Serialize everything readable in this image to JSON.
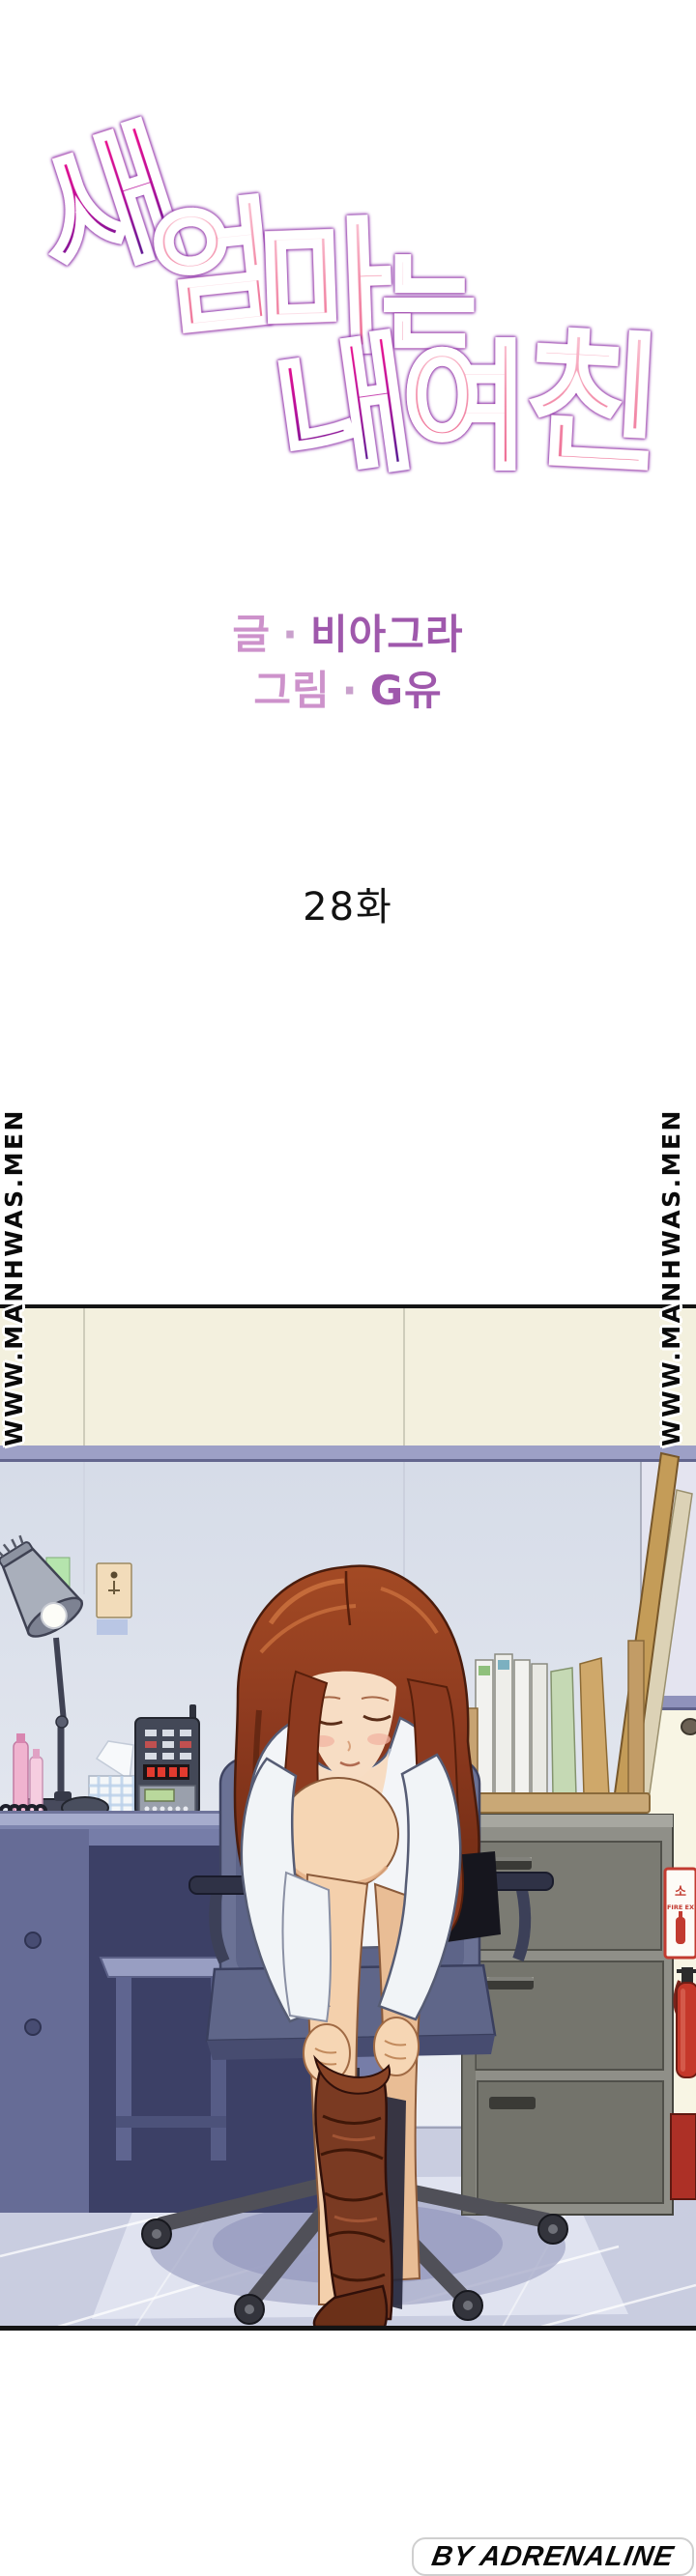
{
  "title": {
    "text": "새엄마는 내여친",
    "chars": [
      {
        "ch": "새",
        "palette": "purple"
      },
      {
        "ch": "엄",
        "palette": "pink"
      },
      {
        "ch": "마",
        "palette": "pink"
      },
      {
        "ch": "는",
        "palette": "pink"
      },
      {
        "ch": "내",
        "palette": "purple"
      },
      {
        "ch": "여",
        "palette": "pink"
      },
      {
        "ch": "친",
        "palette": "pink"
      }
    ]
  },
  "credits": {
    "writer_label": "글",
    "separator": "·",
    "writer_name": "비아그라",
    "artist_label": "그림",
    "artist_name": "G유"
  },
  "episode": {
    "label": "28화"
  },
  "watermark": {
    "text": "WWW.MANHWAS.MEN"
  },
  "panel": {
    "fire_sign": {
      "kr": "소",
      "en": "FIRE EX"
    }
  },
  "footer": {
    "credit": "BY ADRENALINE"
  },
  "colors": {
    "title_purple_top": "#ee108d",
    "title_purple_bottom": "#45178f",
    "title_pink_top": "#f9bccd",
    "title_pink_bottom": "#ee6d94",
    "title_outline": "#8b2fa8",
    "credit_label": "#cd92cb",
    "credit_name": "#9f58ac",
    "episode_text": "#121212",
    "watermark_fill": "#0a0a0a",
    "wall_cream": "#f3f0de",
    "wall_blue": "#dbe1ec",
    "wall_trim": "#9da0c6",
    "floor": "#c9cde0",
    "desk": "#767da8",
    "cabinet": "#8f8f88",
    "hair": "#8d3a1f",
    "skin": "#f6d6b4",
    "shirt": "#f3f5f8",
    "stocking": "#7a3a22",
    "fire_red": "#c23b30",
    "footer_text": "#0a0a0a"
  }
}
